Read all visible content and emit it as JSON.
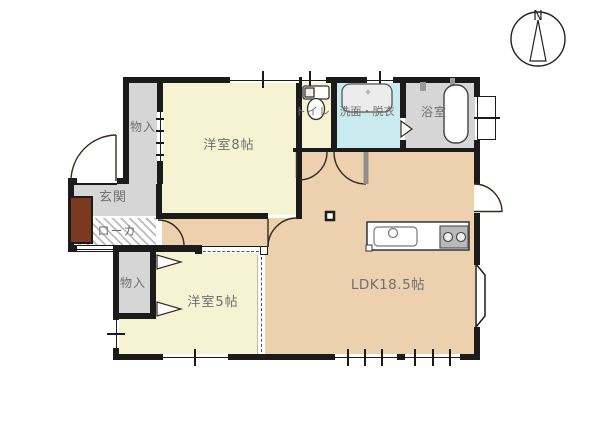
{
  "compass": {
    "north_label": "N"
  },
  "rooms": {
    "storage_top": {
      "label": "物入"
    },
    "bedroom8": {
      "label": "洋室8帖"
    },
    "toilet": {
      "label": "トイレ"
    },
    "washroom": {
      "label": "洗面・脱衣"
    },
    "bathroom": {
      "label": "浴室"
    },
    "entrance": {
      "label": "玄関"
    },
    "hallway": {
      "label": "ローカ"
    },
    "storage_bottom": {
      "label": "物入"
    },
    "bedroom5": {
      "label": "洋室5帖"
    },
    "ldk": {
      "label": "LDK18.5帖"
    }
  },
  "colors": {
    "room_cream": "#f6f3d3",
    "room_tan": "#edd0ae",
    "room_gray": "#d6d6d6",
    "room_blue": "#c9eaee",
    "cabinet_brown": "#7b3a1e",
    "stripe": "#bcbcbc",
    "wall": "#1b1b1b",
    "label_text": "#6f6f6f"
  }
}
